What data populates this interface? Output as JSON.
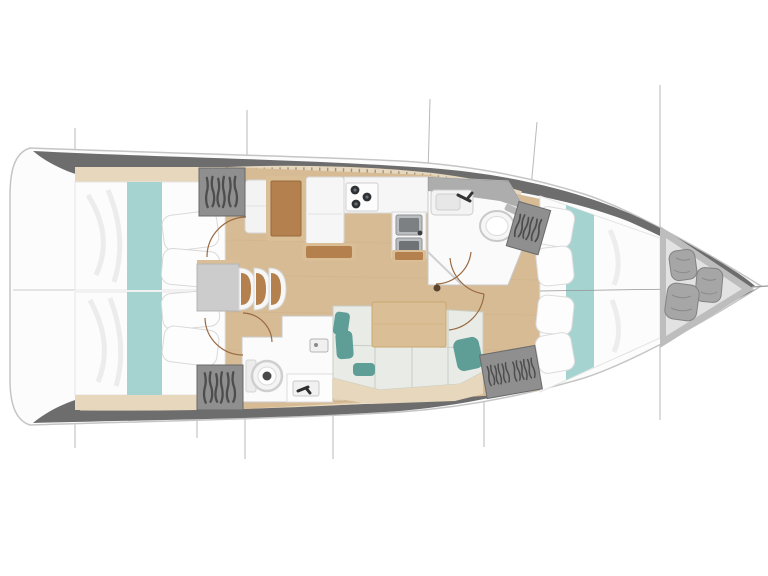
{
  "title": "Sailing yacht interior layout plan — top-down view, bow to the right",
  "palette": {
    "background": "#ffffff",
    "hull_fill": "#fcfcfc",
    "hull_outline": "#c5c5c5",
    "deck_dark": "#6d6d6d",
    "coachroof_beige": "#e7d7bc",
    "window_tick": "#8d8270",
    "floor_wood": "#d6bb95",
    "bedding_white": "#fcfcfc",
    "bed_runner_teal": "#a5d3d0",
    "wardrobe_gray": "#8f8f8f",
    "table_gray": "#cccccc",
    "wood_brown": "#b3804e",
    "wood_trim": "#dabf96",
    "sofa_mint": "#e9ece6",
    "cushion_teal": "#5f9e96",
    "fixture_white": "#f8f8f8",
    "steel_gray": "#b9bdc0",
    "burner_dark": "#2e3134",
    "door_arc_brown": "#9a6a42",
    "locker_floor": "#e2e2e2",
    "fender_gray": "#a6a6a6",
    "line_gray": "#b9b9b9"
  },
  "rooms": [
    {
      "id": "aft-cabin-port",
      "label": "Aft cabin port",
      "features": [
        "double berth",
        "teal runner",
        "two pillows",
        "hanging wardrobe"
      ]
    },
    {
      "id": "aft-cabin-starboard",
      "label": "Aft cabin starboard",
      "features": [
        "double berth",
        "teal runner",
        "two pillows",
        "hanging wardrobe"
      ]
    },
    {
      "id": "saloon",
      "label": "Saloon",
      "features": [
        "saloon table",
        "three folding chairs",
        "bench seat",
        "chart table",
        "L-shaped sofa",
        "wooden table",
        "teal cushions",
        "mast post"
      ]
    },
    {
      "id": "galley",
      "label": "Galley",
      "features": [
        "refrigerator counter",
        "three-burner stove",
        "double stainless sink",
        "island counter"
      ]
    },
    {
      "id": "head-forward",
      "label": "Forward head",
      "features": [
        "wash basin",
        "marine toilet",
        "shower screen"
      ]
    },
    {
      "id": "head-aft",
      "label": "Aft head",
      "features": [
        "marine toilet",
        "wash basin",
        "shower fitting"
      ]
    },
    {
      "id": "forward-cabin",
      "label": "Forward cabin",
      "features": [
        "V-berth",
        "teal runner",
        "four pillows",
        "two hanging wardrobes"
      ]
    },
    {
      "id": "bow-locker",
      "label": "Bow sail locker",
      "features": [
        "three fenders"
      ]
    }
  ]
}
